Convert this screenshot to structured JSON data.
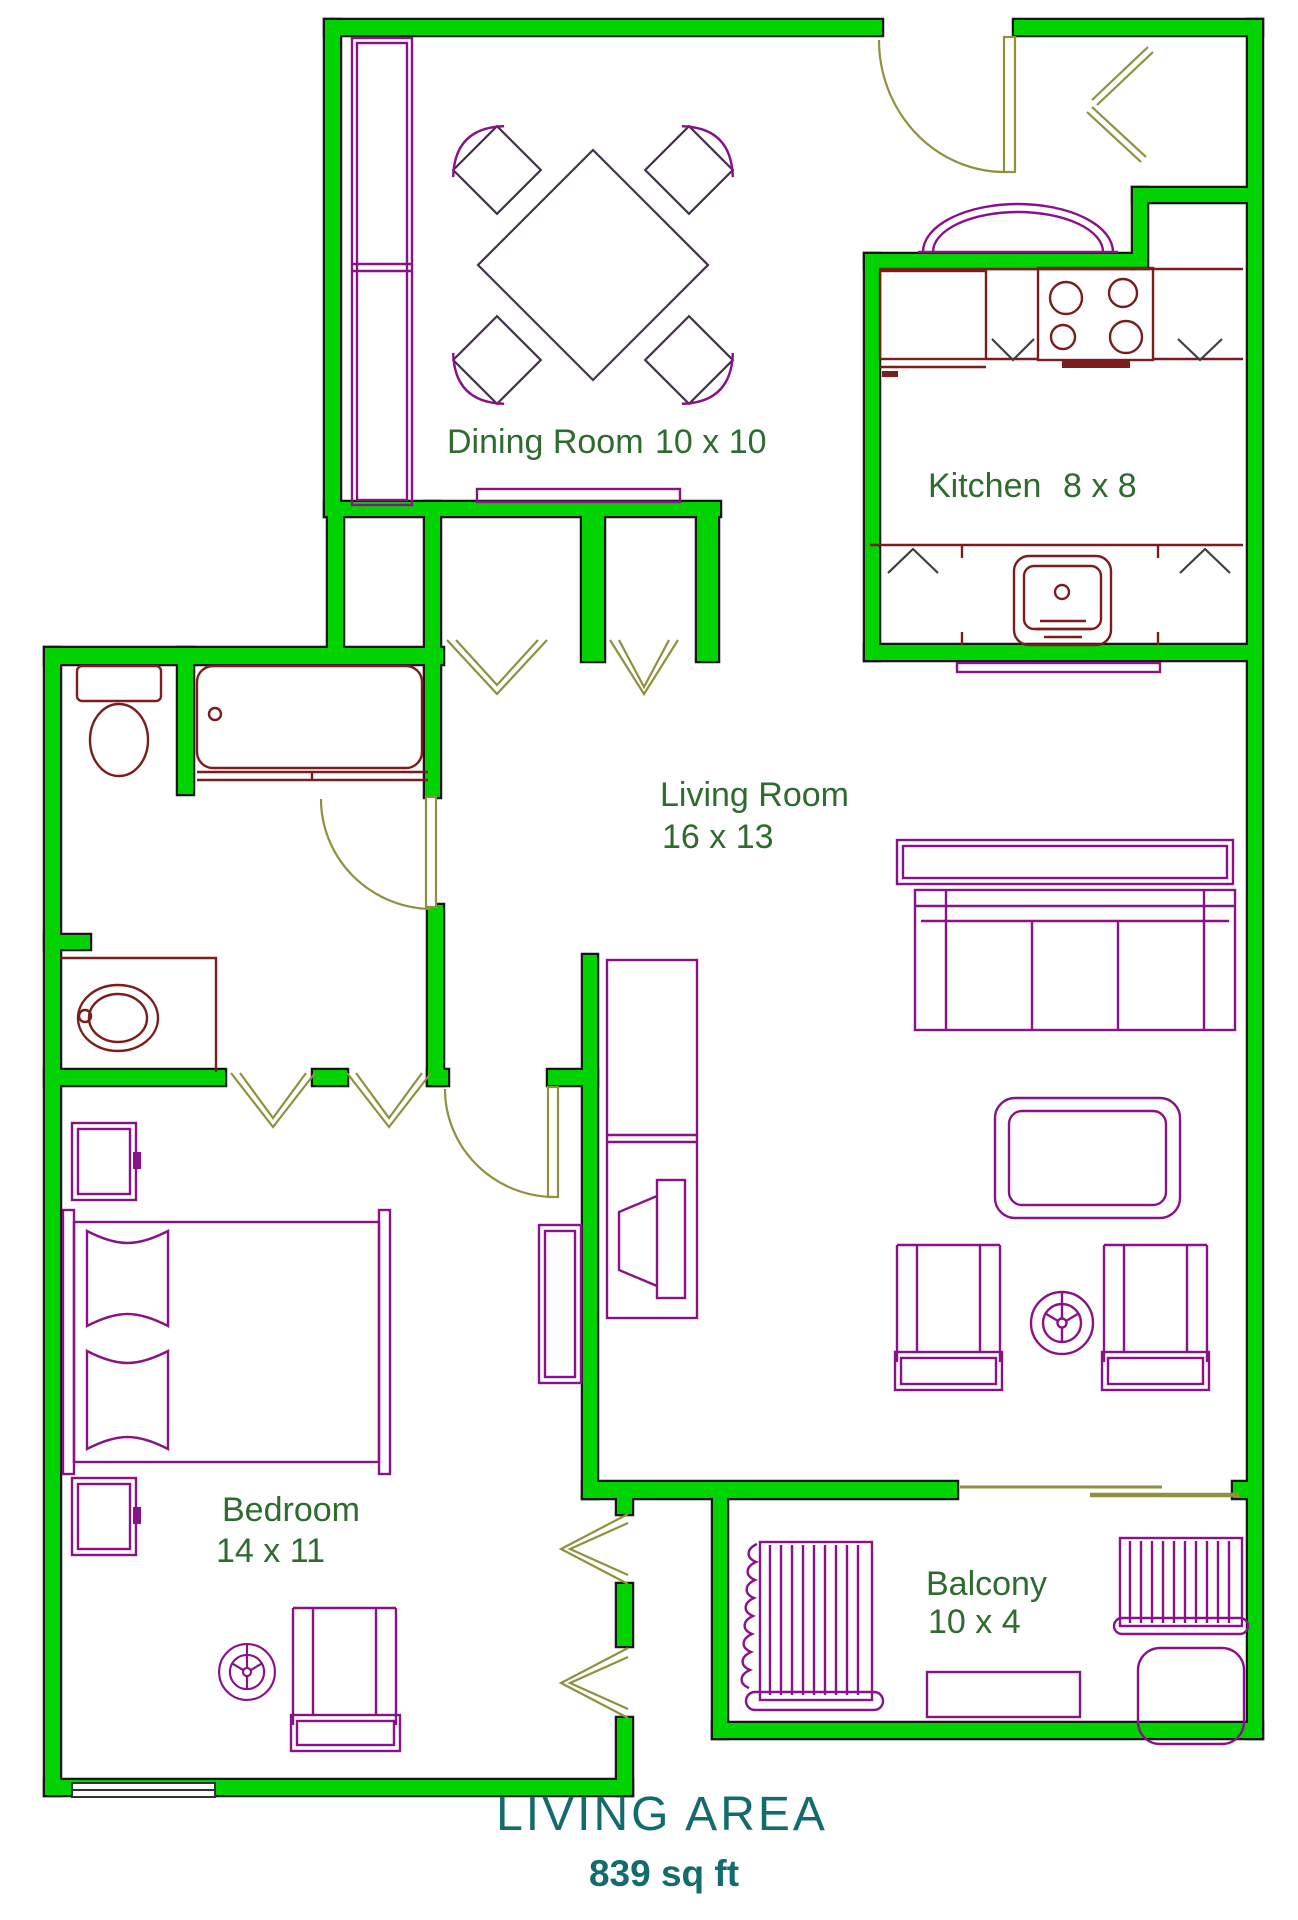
{
  "title": {
    "line1": "LIVING AREA",
    "line2": "839 sq ft"
  },
  "rooms": {
    "dining": {
      "label": "Dining Room",
      "dims": "10 x 10"
    },
    "kitchen": {
      "label": "Kitchen",
      "dims": "8 x 8"
    },
    "living": {
      "label": "Living Room",
      "dims": "16 x 13"
    },
    "bedroom": {
      "label": "Bedroom",
      "dims": "14 x 11"
    },
    "balcony": {
      "label": "Balcony",
      "dims": "10 x 4"
    }
  },
  "colors": {
    "wall_fill": "#00d300",
    "wall_outline": "#161616",
    "furniture": "#8a1289",
    "fixture": "#7c1d1d",
    "door": "#90903e",
    "dining_line": "#44304a",
    "room_label": "#2e6b2e",
    "title": "#146b6e",
    "mark": "#3e3e3e",
    "background": "#ffffff"
  }
}
